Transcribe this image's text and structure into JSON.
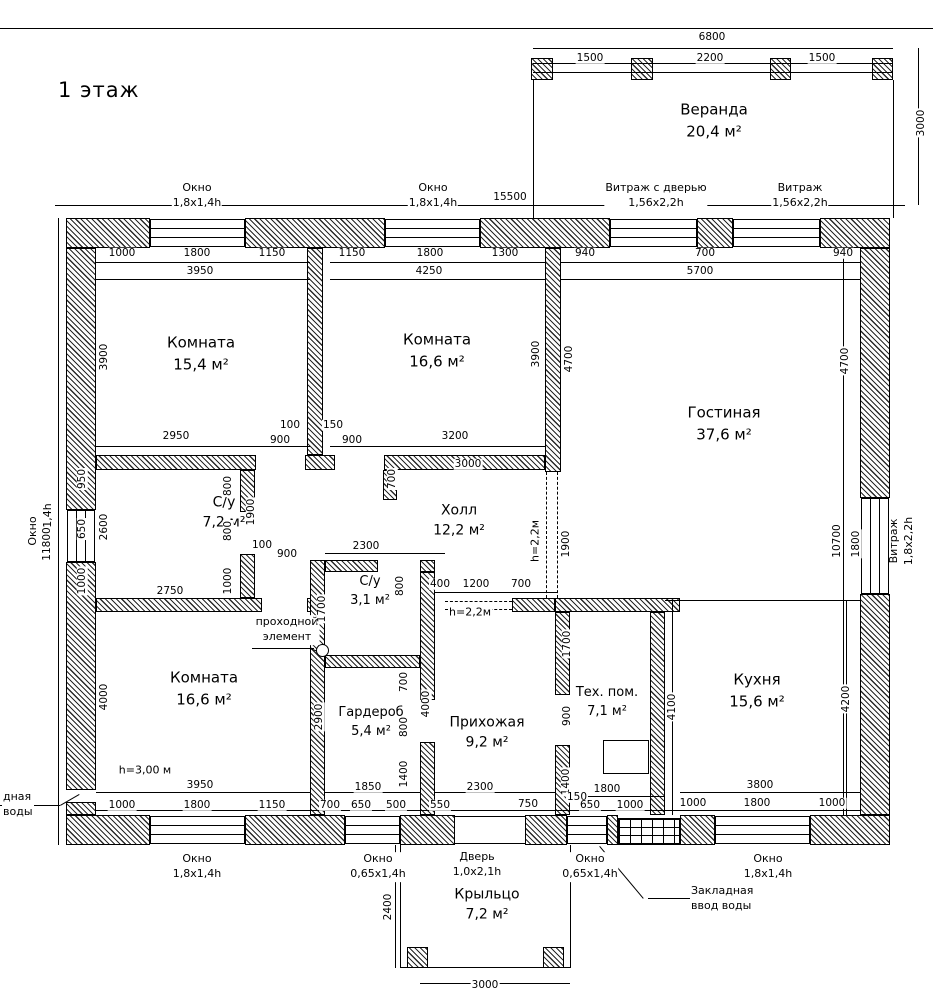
{
  "page": {
    "title": "1 этаж"
  },
  "colors": {
    "line": "#000000",
    "background": "#ffffff"
  },
  "rooms": [
    {
      "name": "Веранда",
      "area": "20,4 м²",
      "x": 714,
      "y": 121,
      "fs": 15
    },
    {
      "name": "Комната",
      "area": "15,4 м²",
      "x": 201,
      "y": 354,
      "fs": 15
    },
    {
      "name": "Комната",
      "area": "16,6 м²",
      "x": 437,
      "y": 351,
      "fs": 15
    },
    {
      "name": "Гостиная",
      "area": "37,6 м²",
      "x": 724,
      "y": 424,
      "fs": 15
    },
    {
      "name": "С/у",
      "area": "7,2 м²",
      "x": 224,
      "y": 513,
      "fs": 14
    },
    {
      "name": "Холл",
      "area": "12,2 м²",
      "x": 459,
      "y": 521,
      "fs": 14
    },
    {
      "name": "С/у",
      "area": "3,1 м²",
      "x": 370,
      "y": 592,
      "fs": 13
    },
    {
      "name": "Комната",
      "area": "16,6 м²",
      "x": 204,
      "y": 689,
      "fs": 15
    },
    {
      "name": "Гардероб",
      "area": "5,4 м²",
      "x": 371,
      "y": 723,
      "fs": 13
    },
    {
      "name": "Прихожая",
      "area": "9,2 м²",
      "x": 487,
      "y": 733,
      "fs": 14
    },
    {
      "name": "Тех. пом.",
      "area": "7,1 м²",
      "x": 607,
      "y": 703,
      "fs": 13
    },
    {
      "name": "Кухня",
      "area": "15,6 м²",
      "x": 757,
      "y": 691,
      "fs": 15
    },
    {
      "name": "Крыльцо",
      "area": "7,2 м²",
      "x": 487,
      "y": 905,
      "fs": 14
    }
  ],
  "opening_labels": [
    {
      "l1": "Окно",
      "l2": "1,8x1,4h",
      "x": 197,
      "y": 196,
      "rot": false
    },
    {
      "l1": "Окно",
      "l2": "1,8x1,4h",
      "x": 433,
      "y": 196,
      "rot": false
    },
    {
      "l1": "Витраж с дверью",
      "l2": "1,56x2,2h",
      "x": 656,
      "y": 196,
      "rot": false
    },
    {
      "l1": "Витраж",
      "l2": "1,56x2,2h",
      "x": 800,
      "y": 196,
      "rot": false
    },
    {
      "l1": "Окно",
      "l2": "0,65x1,4h",
      "x": 41,
      "y": 531,
      "rot": true
    },
    {
      "l1": "Витраж",
      "l2": "1,8x2,2h",
      "x": 902,
      "y": 541,
      "rot": true
    },
    {
      "l1": "Окно",
      "l2": "1,8x1,4h",
      "x": 197,
      "y": 867,
      "rot": false
    },
    {
      "l1": "Окно",
      "l2": "0,65x1,4h",
      "x": 378,
      "y": 867,
      "rot": false
    },
    {
      "l1": "Дверь",
      "l2": "1,0x2,1h",
      "x": 477,
      "y": 865,
      "rot": false
    },
    {
      "l1": "Окно",
      "l2": "0,65x1,4h",
      "x": 590,
      "y": 867,
      "rot": false
    },
    {
      "l1": "Окно",
      "l2": "1,8x1,4h",
      "x": 768,
      "y": 867,
      "rot": false
    }
  ],
  "notes": [
    {
      "l1": "Закладная",
      "l2": "ввод воды",
      "x": 690,
      "y": 899,
      "rot": false,
      "left": true
    },
    {
      "l1": "дная",
      "l2": "воды",
      "x": 2,
      "y": 805,
      "rot": false,
      "left": true
    },
    {
      "l1": "проходной",
      "l2": "элемент",
      "x": 287,
      "y": 630,
      "rot": false,
      "left": false
    },
    {
      "l1": "h=3,00 м",
      "l2": "",
      "x": 145,
      "y": 771,
      "rot": false,
      "left": false
    },
    {
      "l1": "h=2,2м",
      "l2": "",
      "x": 470,
      "y": 613,
      "rot": false,
      "left": false
    },
    {
      "l1": "h=2,2м",
      "l2": "",
      "x": 536,
      "y": 541,
      "rot": true,
      "left": false
    }
  ],
  "dimensions": [
    {
      "t": "6800",
      "x": 712,
      "y": 37,
      "r": 0
    },
    {
      "t": "1500",
      "x": 590,
      "y": 58,
      "r": 0
    },
    {
      "t": "2200",
      "x": 710,
      "y": 58,
      "r": 0
    },
    {
      "t": "1500",
      "x": 822,
      "y": 58,
      "r": 0
    },
    {
      "t": "3000",
      "x": 921,
      "y": 123,
      "r": 1
    },
    {
      "t": "15500",
      "x": 510,
      "y": 197,
      "r": 0
    },
    {
      "t": "1000",
      "x": 122,
      "y": 253,
      "r": 0
    },
    {
      "t": "1800",
      "x": 197,
      "y": 253,
      "r": 0
    },
    {
      "t": "1150",
      "x": 272,
      "y": 253,
      "r": 0
    },
    {
      "t": "3950",
      "x": 200,
      "y": 271,
      "r": 0
    },
    {
      "t": "1150",
      "x": 352,
      "y": 253,
      "r": 0
    },
    {
      "t": "1800",
      "x": 430,
      "y": 253,
      "r": 0
    },
    {
      "t": "1300",
      "x": 505,
      "y": 253,
      "r": 0
    },
    {
      "t": "4250",
      "x": 429,
      "y": 271,
      "r": 0
    },
    {
      "t": "940",
      "x": 585,
      "y": 253,
      "r": 0
    },
    {
      "t": "700",
      "x": 705,
      "y": 253,
      "r": 0
    },
    {
      "t": "940",
      "x": 843,
      "y": 253,
      "r": 0
    },
    {
      "t": "5700",
      "x": 700,
      "y": 271,
      "r": 0
    },
    {
      "t": "3900",
      "x": 104,
      "y": 357,
      "r": 1
    },
    {
      "t": "3900",
      "x": 536,
      "y": 354,
      "r": 1
    },
    {
      "t": "4700",
      "x": 569,
      "y": 359,
      "r": 1
    },
    {
      "t": "4700",
      "x": 845,
      "y": 361,
      "r": 1
    },
    {
      "t": "2950",
      "x": 176,
      "y": 436,
      "r": 0
    },
    {
      "t": "100",
      "x": 290,
      "y": 425,
      "r": 0
    },
    {
      "t": "900",
      "x": 280,
      "y": 440,
      "r": 0
    },
    {
      "t": "150",
      "x": 333,
      "y": 425,
      "r": 0
    },
    {
      "t": "900",
      "x": 352,
      "y": 440,
      "r": 0
    },
    {
      "t": "3200",
      "x": 455,
      "y": 436,
      "r": 0
    },
    {
      "t": "3000",
      "x": 468,
      "y": 464,
      "r": 0
    },
    {
      "t": "700",
      "x": 392,
      "y": 479,
      "r": 1
    },
    {
      "t": "950",
      "x": 82,
      "y": 479,
      "r": 1
    },
    {
      "t": "650",
      "x": 82,
      "y": 529,
      "r": 1
    },
    {
      "t": "1000",
      "x": 82,
      "y": 581,
      "r": 1
    },
    {
      "t": "2600",
      "x": 104,
      "y": 527,
      "r": 1
    },
    {
      "t": "800",
      "x": 228,
      "y": 486,
      "r": 1
    },
    {
      "t": "800",
      "x": 228,
      "y": 531,
      "r": 1
    },
    {
      "t": "1000",
      "x": 228,
      "y": 581,
      "r": 1
    },
    {
      "t": "1900",
      "x": 251,
      "y": 512,
      "r": 1
    },
    {
      "t": "2750",
      "x": 170,
      "y": 591,
      "r": 0
    },
    {
      "t": "100",
      "x": 262,
      "y": 545,
      "r": 0
    },
    {
      "t": "900",
      "x": 287,
      "y": 554,
      "r": 0
    },
    {
      "t": "2300",
      "x": 366,
      "y": 546,
      "r": 0
    },
    {
      "t": "1900",
      "x": 566,
      "y": 544,
      "r": 1
    },
    {
      "t": "400",
      "x": 440,
      "y": 584,
      "r": 0
    },
    {
      "t": "1200",
      "x": 476,
      "y": 584,
      "r": 0
    },
    {
      "t": "700",
      "x": 521,
      "y": 584,
      "r": 0
    },
    {
      "t": "10700",
      "x": 837,
      "y": 541,
      "r": 1
    },
    {
      "t": "1800",
      "x": 856,
      "y": 544,
      "r": 1
    },
    {
      "t": "800",
      "x": 400,
      "y": 586,
      "r": 1
    },
    {
      "t": "1700",
      "x": 322,
      "y": 609,
      "r": 1
    },
    {
      "t": "700",
      "x": 404,
      "y": 682,
      "r": 1
    },
    {
      "t": "800",
      "x": 404,
      "y": 727,
      "r": 1
    },
    {
      "t": "2900",
      "x": 319,
      "y": 717,
      "r": 1
    },
    {
      "t": "4000",
      "x": 426,
      "y": 704,
      "r": 1
    },
    {
      "t": "1400",
      "x": 404,
      "y": 774,
      "r": 1
    },
    {
      "t": "1850",
      "x": 368,
      "y": 787,
      "r": 0
    },
    {
      "t": "4000",
      "x": 104,
      "y": 697,
      "r": 1
    },
    {
      "t": "3950",
      "x": 200,
      "y": 785,
      "r": 0
    },
    {
      "t": "1000",
      "x": 122,
      "y": 805,
      "r": 0
    },
    {
      "t": "1800",
      "x": 197,
      "y": 805,
      "r": 0
    },
    {
      "t": "1150",
      "x": 272,
      "y": 805,
      "r": 0
    },
    {
      "t": "700",
      "x": 330,
      "y": 805,
      "r": 0
    },
    {
      "t": "650",
      "x": 361,
      "y": 805,
      "r": 0
    },
    {
      "t": "500",
      "x": 396,
      "y": 805,
      "r": 0
    },
    {
      "t": "2300",
      "x": 480,
      "y": 787,
      "r": 0
    },
    {
      "t": "550",
      "x": 440,
      "y": 805,
      "r": 0
    },
    {
      "t": "750",
      "x": 528,
      "y": 804,
      "r": 0
    },
    {
      "t": "1700",
      "x": 567,
      "y": 644,
      "r": 1
    },
    {
      "t": "900",
      "x": 567,
      "y": 716,
      "r": 1
    },
    {
      "t": "1400",
      "x": 566,
      "y": 782,
      "r": 1
    },
    {
      "t": "4100",
      "x": 672,
      "y": 707,
      "r": 1
    },
    {
      "t": "1800",
      "x": 607,
      "y": 789,
      "r": 0
    },
    {
      "t": "150",
      "x": 577,
      "y": 797,
      "r": 0
    },
    {
      "t": "650",
      "x": 590,
      "y": 805,
      "r": 0
    },
    {
      "t": "1000",
      "x": 630,
      "y": 805,
      "r": 0
    },
    {
      "t": "4200",
      "x": 846,
      "y": 699,
      "r": 1
    },
    {
      "t": "3800",
      "x": 760,
      "y": 785,
      "r": 0
    },
    {
      "t": "1000",
      "x": 693,
      "y": 803,
      "r": 0
    },
    {
      "t": "1800",
      "x": 757,
      "y": 803,
      "r": 0
    },
    {
      "t": "1000",
      "x": 832,
      "y": 803,
      "r": 0
    },
    {
      "t": "11800",
      "x": 47,
      "y": 544,
      "r": 1
    },
    {
      "t": "2400",
      "x": 388,
      "y": 907,
      "r": 1
    },
    {
      "t": "3000",
      "x": 485,
      "y": 985,
      "r": 0
    }
  ]
}
